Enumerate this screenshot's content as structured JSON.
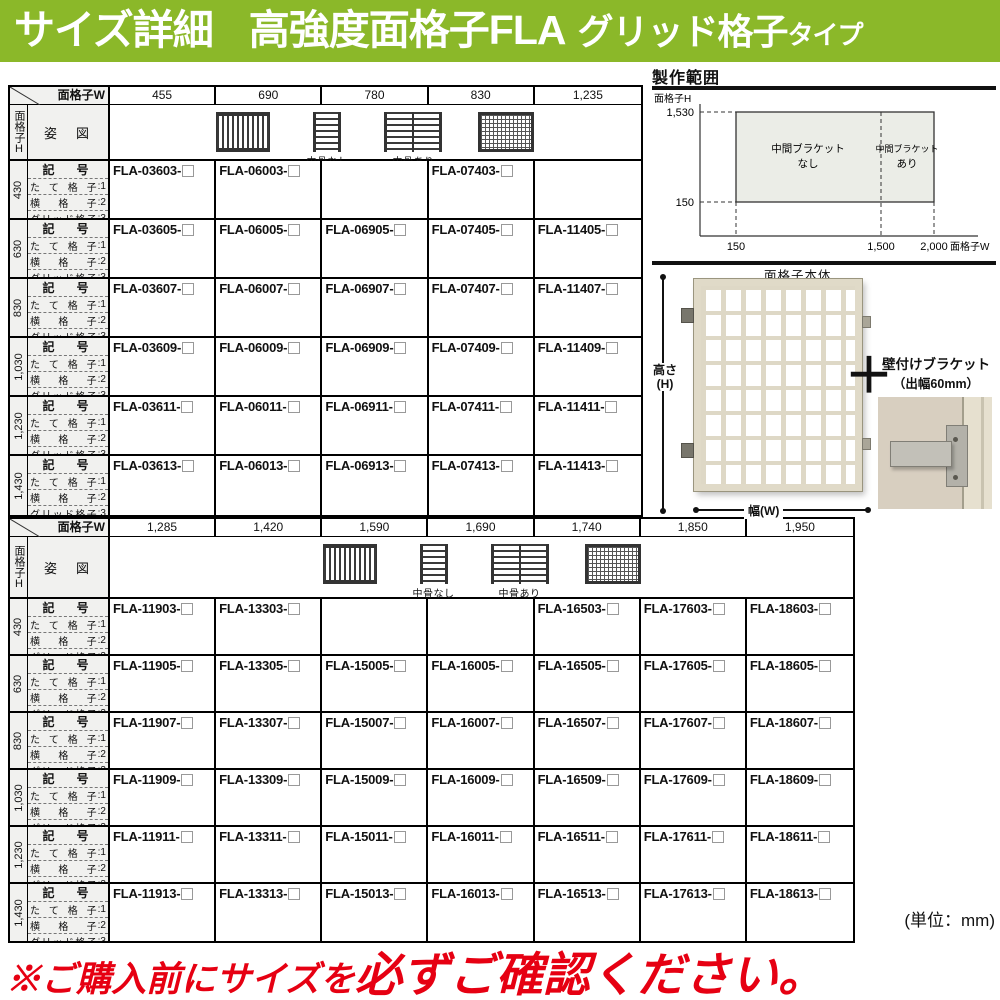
{
  "banner": {
    "part1": "サイズ詳細",
    "part2": "高強度面格子FLA",
    "part3": "グリッド格子",
    "part4": "タイプ"
  },
  "common": {
    "width_axis": "面格子W",
    "height_axis": "面格子H",
    "sugata_label": "姿　図",
    "code_label": "記　号",
    "legend": [
      [
        "たて格子",
        ":1"
      ],
      [
        "横格子",
        ":2"
      ],
      [
        "グリッド格子",
        ":3"
      ]
    ],
    "nakabone_nashi": "中骨なし",
    "nakabone_ari": "中骨あり"
  },
  "table1": {
    "widths": [
      "455",
      "690",
      "780",
      "830",
      "1,235"
    ],
    "rows": [
      {
        "h": "430",
        "codes": [
          "FLA-03603-",
          "FLA-06003-",
          "",
          "FLA-07403-",
          ""
        ]
      },
      {
        "h": "630",
        "codes": [
          "FLA-03605-",
          "FLA-06005-",
          "FLA-06905-",
          "FLA-07405-",
          "FLA-11405-"
        ]
      },
      {
        "h": "830",
        "codes": [
          "FLA-03607-",
          "FLA-06007-",
          "FLA-06907-",
          "FLA-07407-",
          "FLA-11407-"
        ]
      },
      {
        "h": "1,030",
        "codes": [
          "FLA-03609-",
          "FLA-06009-",
          "FLA-06909-",
          "FLA-07409-",
          "FLA-11409-"
        ]
      },
      {
        "h": "1,230",
        "codes": [
          "FLA-03611-",
          "FLA-06011-",
          "FLA-06911-",
          "FLA-07411-",
          "FLA-11411-"
        ]
      },
      {
        "h": "1,430",
        "codes": [
          "FLA-03613-",
          "FLA-06013-",
          "FLA-06913-",
          "FLA-07413-",
          "FLA-11413-"
        ]
      }
    ]
  },
  "table2": {
    "widths": [
      "1,285",
      "1,420",
      "1,590",
      "1,690",
      "1,740",
      "1,850",
      "1,950"
    ],
    "rows": [
      {
        "h": "430",
        "codes": [
          "FLA-11903-",
          "FLA-13303-",
          "",
          "",
          "FLA-16503-",
          "FLA-17603-",
          "FLA-18603-"
        ]
      },
      {
        "h": "630",
        "codes": [
          "FLA-11905-",
          "FLA-13305-",
          "FLA-15005-",
          "FLA-16005-",
          "FLA-16505-",
          "FLA-17605-",
          "FLA-18605-"
        ]
      },
      {
        "h": "830",
        "codes": [
          "FLA-11907-",
          "FLA-13307-",
          "FLA-15007-",
          "FLA-16007-",
          "FLA-16507-",
          "FLA-17607-",
          "FLA-18607-"
        ]
      },
      {
        "h": "1,030",
        "codes": [
          "FLA-11909-",
          "FLA-13309-",
          "FLA-15009-",
          "FLA-16009-",
          "FLA-16509-",
          "FLA-17609-",
          "FLA-18609-"
        ]
      },
      {
        "h": "1,230",
        "codes": [
          "FLA-11911-",
          "FLA-13311-",
          "FLA-15011-",
          "FLA-16011-",
          "FLA-16511-",
          "FLA-17611-",
          "FLA-18611-"
        ]
      },
      {
        "h": "1,430",
        "codes": [
          "FLA-11913-",
          "FLA-13313-",
          "FLA-15013-",
          "FLA-16013-",
          "FLA-16513-",
          "FLA-17613-",
          "FLA-18613-"
        ]
      }
    ]
  },
  "production_range": {
    "title": "製作範囲",
    "y_axis_label": "面格子H",
    "x_axis_label": "面格子W",
    "y_ticks": [
      "1,530",
      "150"
    ],
    "x_ticks": [
      "150",
      "1,500",
      "2,000"
    ],
    "region_left_line1": "中間ブラケット",
    "region_left_line2": "なし",
    "region_right_line1": "中間ブラケット",
    "region_right_line2": "あり",
    "region_fill": "#ebede7",
    "x_range": [
      150,
      2000
    ],
    "y_range": [
      150,
      1530
    ],
    "divider_x": 1500
  },
  "product": {
    "body_label": "面格子本体",
    "height_label_1": "高さ",
    "height_label_2": "(H)",
    "width_label": "幅(W)",
    "plus_sign": "＋",
    "bracket_line1": "壁付けブラケット",
    "bracket_line2": "（出幅60mm）"
  },
  "footer": {
    "unit": "(単位：mm)",
    "warning_1": "※ご購入前にサイズを",
    "warning_2": "必ずご確認ください。"
  },
  "colors": {
    "banner_green": "#8bb829",
    "header_gray": "#f1f1ef",
    "warning_red": "#e60012"
  }
}
